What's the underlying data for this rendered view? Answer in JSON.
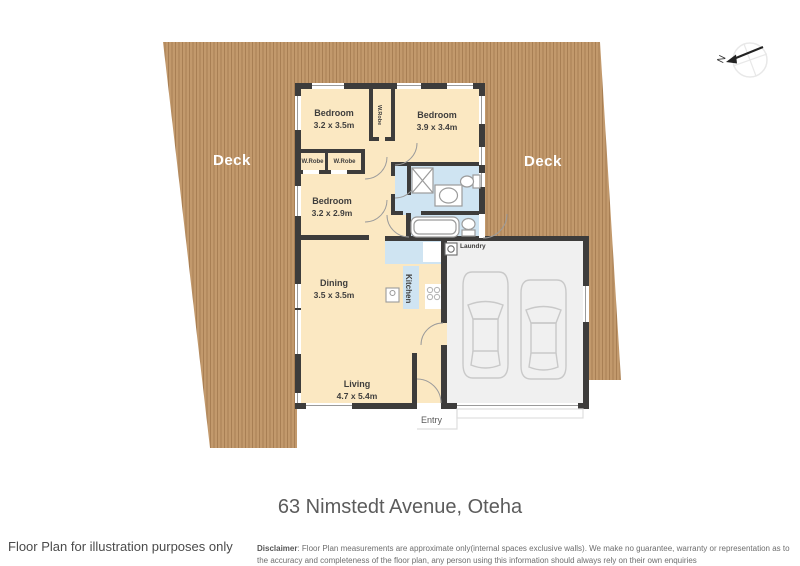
{
  "colors": {
    "deck": "#c2996c",
    "deck_stripe": "#a87f54",
    "deck_label": "#ffffff",
    "wall": "#3d3c3b",
    "room": "#fbe8c2",
    "wet": "#cfe4f2",
    "garage": "#f0f0f0",
    "window_line": "#9a9a9a",
    "label": "#3f3e3d",
    "car_outline": "#c9c9c9"
  },
  "plan": {
    "deck_left_label": "Deck",
    "deck_right_label": "Deck",
    "rooms": {
      "bedroom1": {
        "name": "Bedroom",
        "dims": "3.2 x 3.5m"
      },
      "bedroom2": {
        "name": "Bedroom",
        "dims": "3.9 x 3.4m"
      },
      "bedroom3": {
        "name": "Bedroom",
        "dims": "3.2 x 2.9m"
      },
      "dining": {
        "name": "Dining",
        "dims": "3.5 x 3.5m"
      },
      "living": {
        "name": "Living",
        "dims": "4.7 x 5.4m"
      },
      "kitchen": {
        "name": "Kitchen"
      },
      "laundry": {
        "name": "Laundry"
      },
      "entry": {
        "name": "Entry"
      }
    },
    "closets": {
      "wrobe_left": "W.Robe",
      "wrobe_right": "W.Robe",
      "wrobe_hall": "W.Robe"
    },
    "compass": {
      "north": "N"
    }
  },
  "footer": {
    "address": "63 Nimstedt Avenue, Oteha",
    "note": "Floor Plan for illustration purposes only",
    "disclaimer_label": "Disclaimer",
    "disclaimer_text": ": Floor Plan measurements are approximate only(internal spaces exclusive walls). We make no guarantee, warranty or representation as to the accuracy and completeness of the floor plan, any person using this information should always rely on their own enquiries"
  }
}
